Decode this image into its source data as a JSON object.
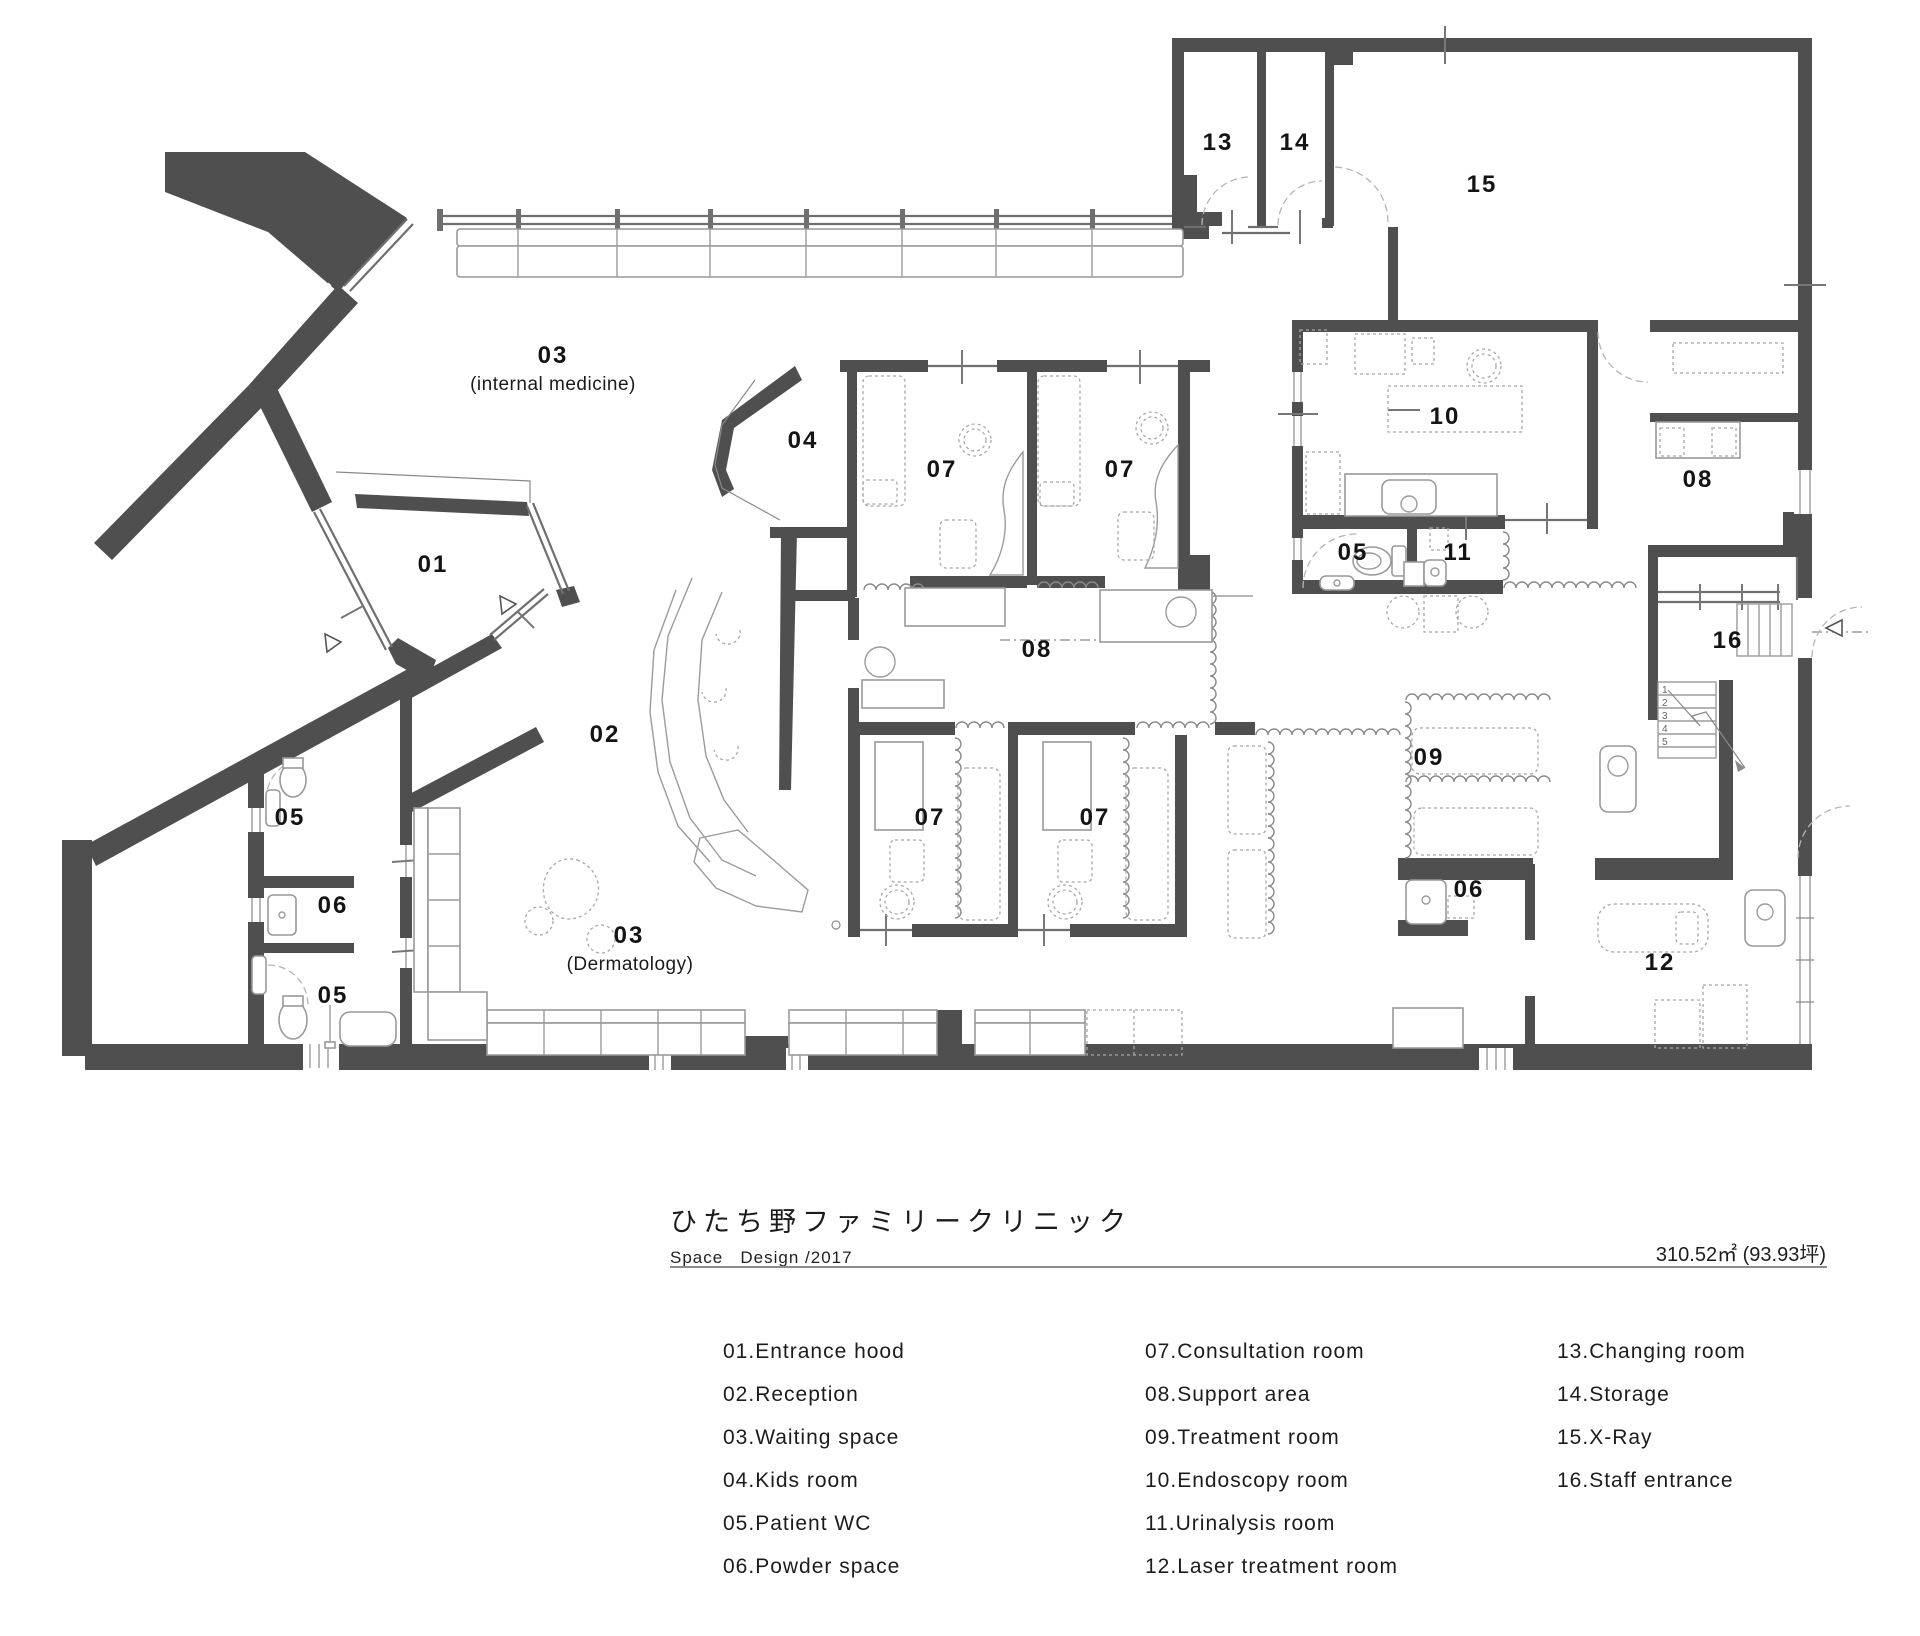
{
  "document": {
    "title": "ひたち野ファミリークリニック",
    "subtitle": "Space   Design /2017",
    "area": "310.52㎡ (93.93坪)"
  },
  "legend": {
    "columns": [
      [
        "01.Entrance hood",
        "02.Reception",
        "03.Waiting space",
        "04.Kids room",
        "05.Patient WC",
        "06.Powder space"
      ],
      [
        "07.Consultation room",
        "08.Support area",
        "09.Treatment room",
        "10.Endoscopy room",
        "11.Urinalysis room",
        "12.Laser treatment room"
      ],
      [
        "13.Changing room",
        "14.Storage",
        "15.X-Ray",
        "16.Staff entrance"
      ]
    ]
  },
  "plan": {
    "labels": [
      {
        "text": "01",
        "x": 433,
        "y": 572
      },
      {
        "text": "02",
        "x": 605,
        "y": 742
      },
      {
        "text": "03",
        "x": 553,
        "y": 363
      },
      {
        "text": "03",
        "x": 629,
        "y": 943
      },
      {
        "text": "04",
        "x": 803,
        "y": 448
      },
      {
        "text": "05",
        "x": 290,
        "y": 825
      },
      {
        "text": "05",
        "x": 333,
        "y": 1003
      },
      {
        "text": "05",
        "x": 1353,
        "y": 560
      },
      {
        "text": "06",
        "x": 333,
        "y": 913
      },
      {
        "text": "06",
        "x": 1469,
        "y": 897
      },
      {
        "text": "07",
        "x": 942,
        "y": 477
      },
      {
        "text": "07",
        "x": 1120,
        "y": 477
      },
      {
        "text": "07",
        "x": 930,
        "y": 825
      },
      {
        "text": "07",
        "x": 1095,
        "y": 825
      },
      {
        "text": "08",
        "x": 1037,
        "y": 657
      },
      {
        "text": "08",
        "x": 1698,
        "y": 487
      },
      {
        "text": "09",
        "x": 1429,
        "y": 765
      },
      {
        "text": "10",
        "x": 1445,
        "y": 424
      },
      {
        "text": "11",
        "x": 1458,
        "y": 560
      },
      {
        "text": "12",
        "x": 1660,
        "y": 970
      },
      {
        "text": "13",
        "x": 1218,
        "y": 150
      },
      {
        "text": "14",
        "x": 1295,
        "y": 150
      },
      {
        "text": "15",
        "x": 1482,
        "y": 192
      },
      {
        "text": "16",
        "x": 1728,
        "y": 648
      }
    ],
    "sublabels": [
      {
        "text": "(internal medicine)",
        "x": 553,
        "y": 390
      },
      {
        "text": "(Dermatology)",
        "x": 630,
        "y": 970
      }
    ],
    "stair_steps": [
      "1",
      "2",
      "3",
      "4",
      "5"
    ]
  },
  "colors": {
    "wall": "#4f4f4f",
    "furniture": "#9b9b9b",
    "text": "#141414"
  }
}
